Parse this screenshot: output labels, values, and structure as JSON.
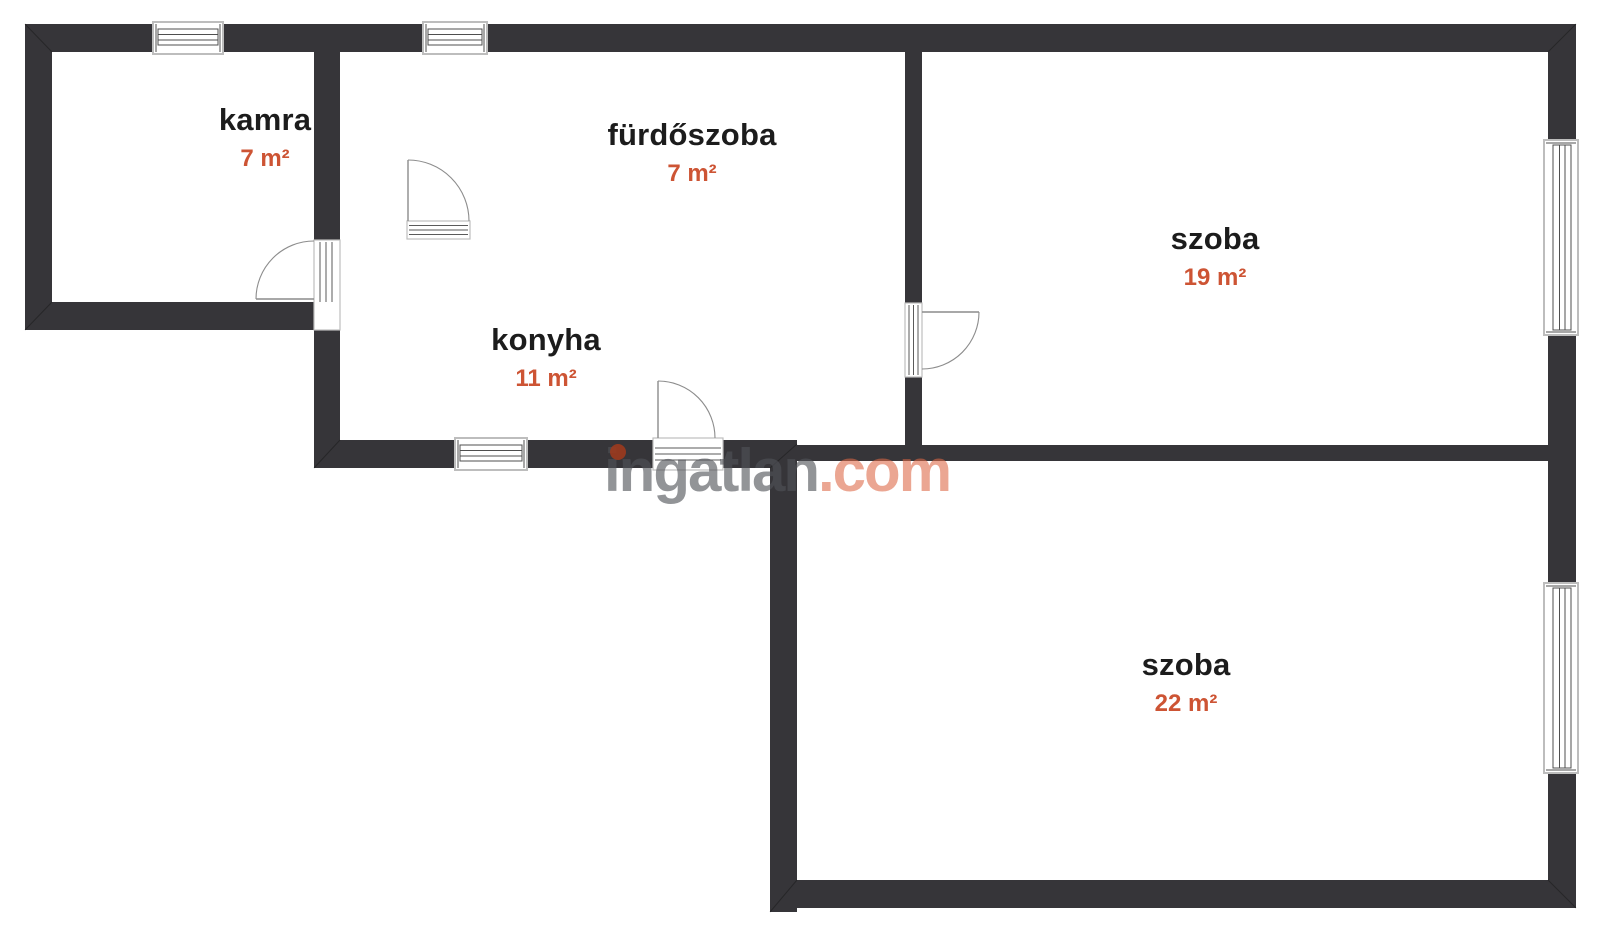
{
  "watermark": {
    "brand": "ingatlan",
    "tld": ".com"
  },
  "rooms": [
    {
      "key": "kamra",
      "name": "kamra",
      "area": "7 m²"
    },
    {
      "key": "furdoszoba",
      "name": "fürdőszoba",
      "area": "7 m²"
    },
    {
      "key": "konyha",
      "name": "konyha",
      "area": "11 m²"
    },
    {
      "key": "szoba-north",
      "name": "szoba",
      "area": "19 m²"
    },
    {
      "key": "szoba-south",
      "name": "szoba",
      "area": "22 m²"
    }
  ],
  "colors": {
    "background": "#ffffff",
    "wall": "#363539",
    "room_name": "#1c1c1c",
    "area_text": "#cd5434",
    "window_frame": "#bdbdbd",
    "window_line": "#4f4f4f",
    "door_line": "#8c8c8c",
    "watermark_gray": "#515359",
    "watermark_accent": "#dd6745",
    "watermark_dot": "#9c3a1e"
  }
}
